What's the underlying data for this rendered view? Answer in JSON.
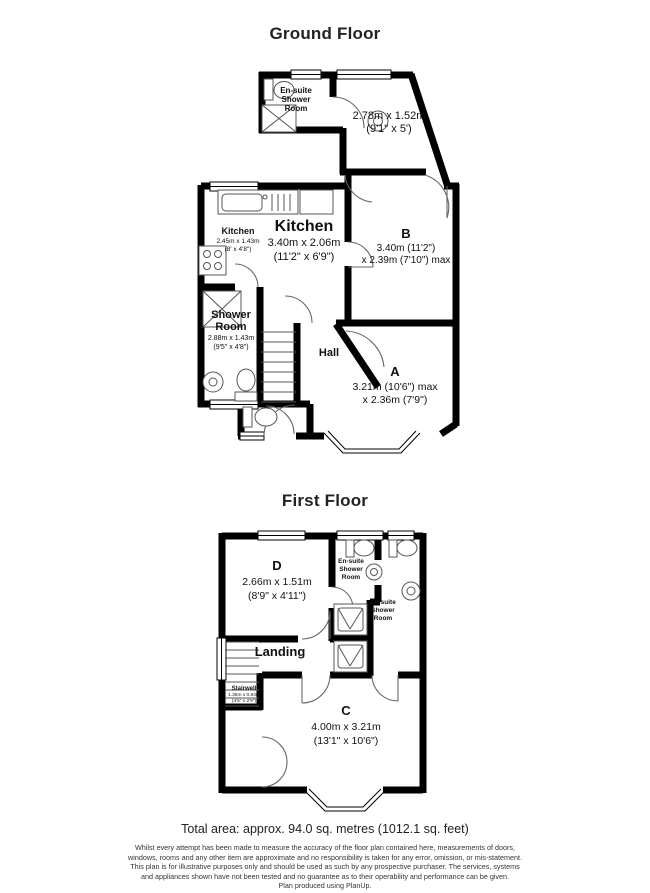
{
  "groundFloor": {
    "title": "Ground Floor",
    "ensuite": [
      "En-suite",
      "Shower",
      "Room"
    ],
    "topRoom": [
      "2.78m x 1.52m",
      "(9'1\" x 5')"
    ],
    "kitchenSmall": [
      "Kitchen",
      "2.45m x 1.43m",
      "(8' x 4'8\")"
    ],
    "kitchen": [
      "Kitchen",
      "3.40m x 2.06m",
      "(11'2\" x 6'9\")"
    ],
    "roomB": [
      "B",
      "3.40m (11'2\")",
      "x 2.39m (7'10\") max"
    ],
    "showerRoom": [
      "Shower",
      "Room",
      "2.88m x 1.43m",
      "(9'5\" x 4'8\")"
    ],
    "hall": "Hall",
    "roomA": [
      "A",
      "3.21m (10'6\") max",
      "x 2.36m (7'9\")"
    ]
  },
  "firstFloor": {
    "title": "First Floor",
    "roomD": [
      "D",
      "2.66m x 1.51m",
      "(8'9\" x 4'11\")"
    ],
    "ensuite1": [
      "En-suite",
      "Shower",
      "Room"
    ],
    "ensuite2": [
      "En-suite",
      "Shower",
      "Room"
    ],
    "landing": "Landing",
    "stairwell": [
      "Stairwell",
      "1.35m x 0.84m",
      "(4'5\" x 2'9\")"
    ],
    "roomC": [
      "C",
      "4.00m x 3.21m",
      "(13'1\" x 10'6\")"
    ]
  },
  "footer": {
    "totalArea": "Total area: approx. 94.0 sq. metres (1012.1 sq. feet)",
    "disclaimer": [
      "Whilst every attempt has been made to measure the accuracy of the floor plan contained here, measurements of doors,",
      "windows, rooms and any other item are approximate and no responsibility is taken for any error, omission, or mis-statement.",
      "This plan is for illustrative purposes only and should be used as such by any prospective purchaser.  The services, systems",
      "and appliances shown have not been tested and no guarantee as to their operability and performance can be given.",
      "Plan produced using PlanUp."
    ]
  },
  "colors": {
    "wall": "#000000",
    "background": "#ffffff"
  }
}
